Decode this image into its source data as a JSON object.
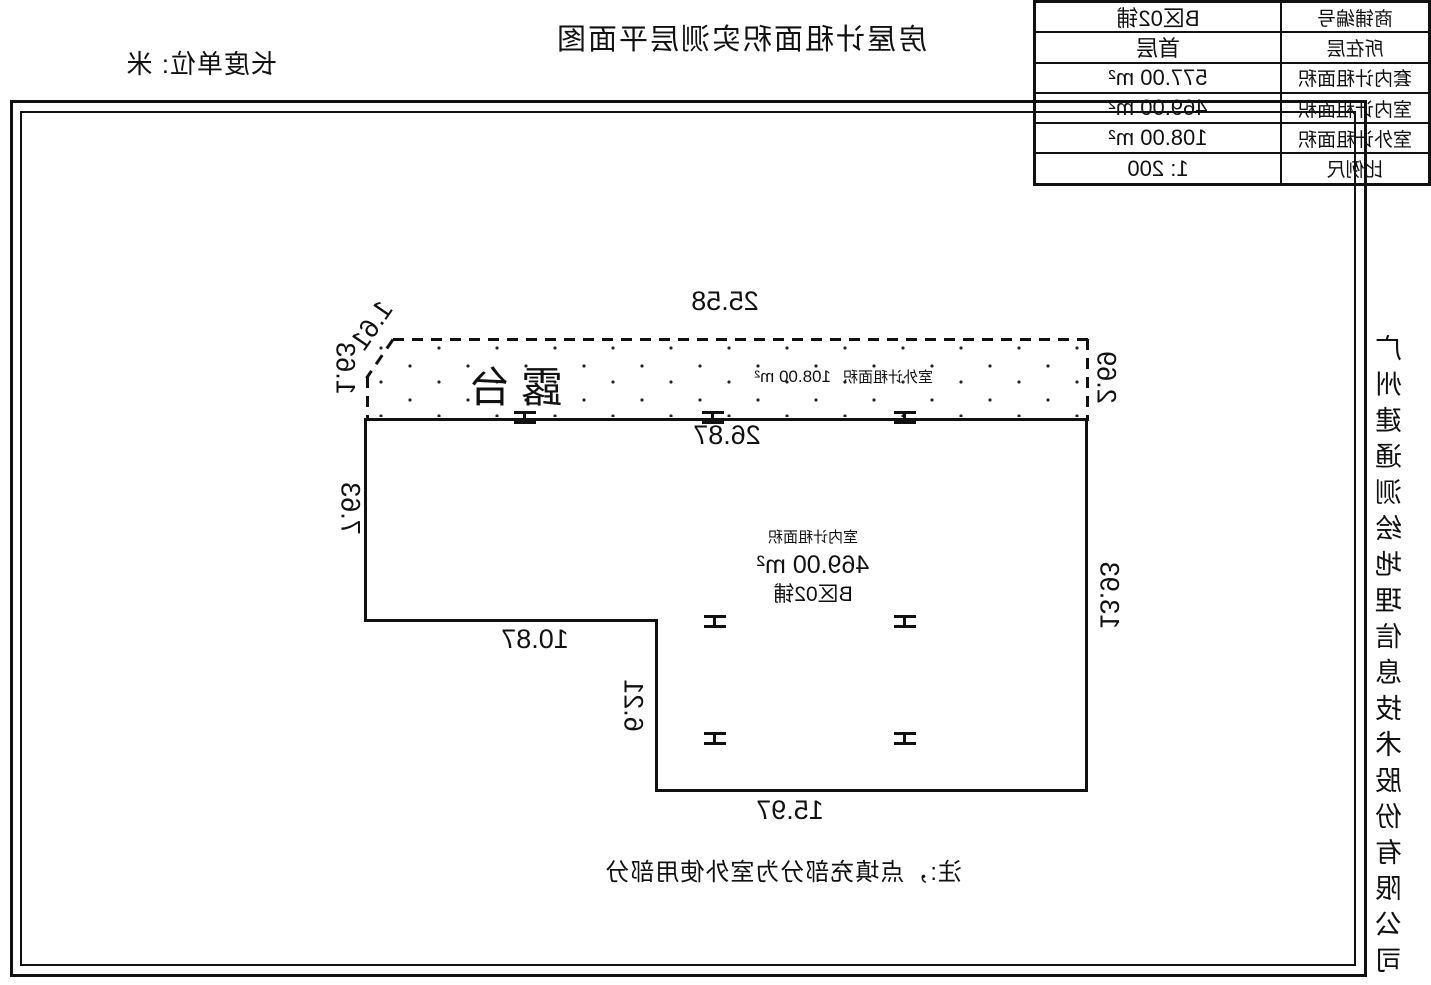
{
  "title": "房屋计租面积实测层平面图",
  "unit_label": "长度单位: 米",
  "company": "广州建通测绘地理信息技术股份有限公司",
  "plan": {
    "terrace_label": "露台",
    "outdoor": {
      "label": "室外计租面积",
      "value": "108.00 m²"
    },
    "indoor": {
      "label": "室内计租面积",
      "value": "469.00 m²",
      "shop": "B区02铺"
    },
    "note": "注:，点填充部分为室外使用部分",
    "dims": {
      "terrace_top": "25.58",
      "chamfer": "1.61",
      "terrace_right": "1.63",
      "terrace_left": "2.69",
      "indoor_top": "26.87",
      "right_upper": "7.63",
      "left_wall": "13.93",
      "step": "10.87",
      "notch": "6.21",
      "bottom": "15.97"
    }
  },
  "info_table": {
    "rows": [
      {
        "label": "商铺编号",
        "value": "B区02铺"
      },
      {
        "label": "所在层",
        "value": "首层"
      },
      {
        "label": "套内计租面积",
        "value": "577.00 m²"
      },
      {
        "label": "室内计租面积",
        "value": "469.00 m²"
      },
      {
        "label": "室外计租面积",
        "value": "108.00 m²"
      },
      {
        "label": "比例尺",
        "value": "1: 200"
      }
    ]
  }
}
